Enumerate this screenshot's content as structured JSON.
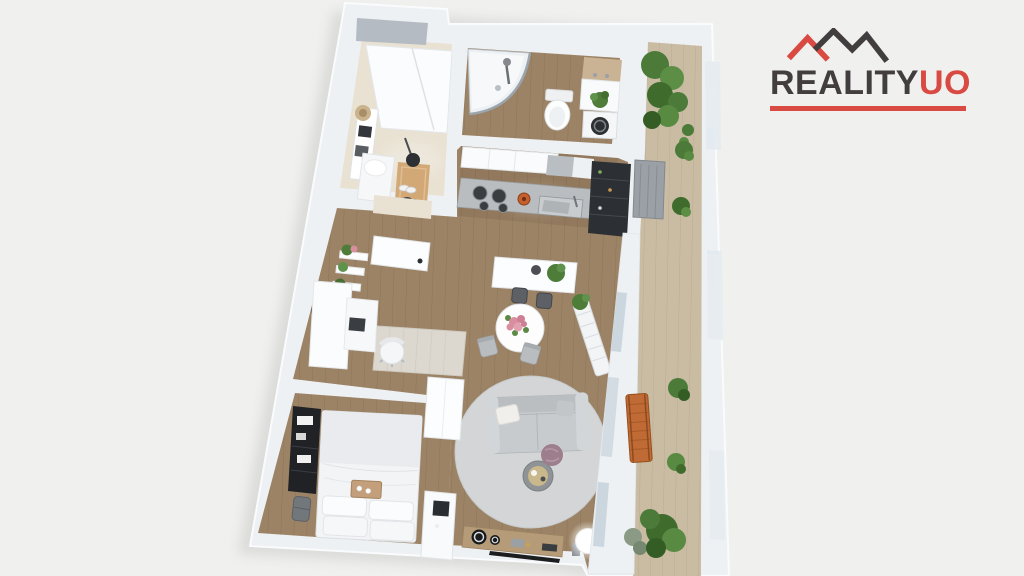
{
  "logo": {
    "word_primary": "REALITY",
    "word_accent": "UO",
    "roof_icon": "zigzag-roofline-icon"
  },
  "colors": {
    "background": "#f0f0ee",
    "logo_dark": "#423e3f",
    "logo_red": "#d94a42",
    "wall": "#eef1f4",
    "wood_floor": "#9c8366",
    "wood_line": "#8b7456",
    "balcony_floor": "#c9bca3",
    "balcony_line": "#baac91",
    "hall_floor": "#e9e2d3",
    "rug_gray": "#d3d5d6",
    "sofa_gray": "#c8cbcd",
    "plant_green": "#4e7d3a",
    "accent_wood": "#b59b77"
  }
}
